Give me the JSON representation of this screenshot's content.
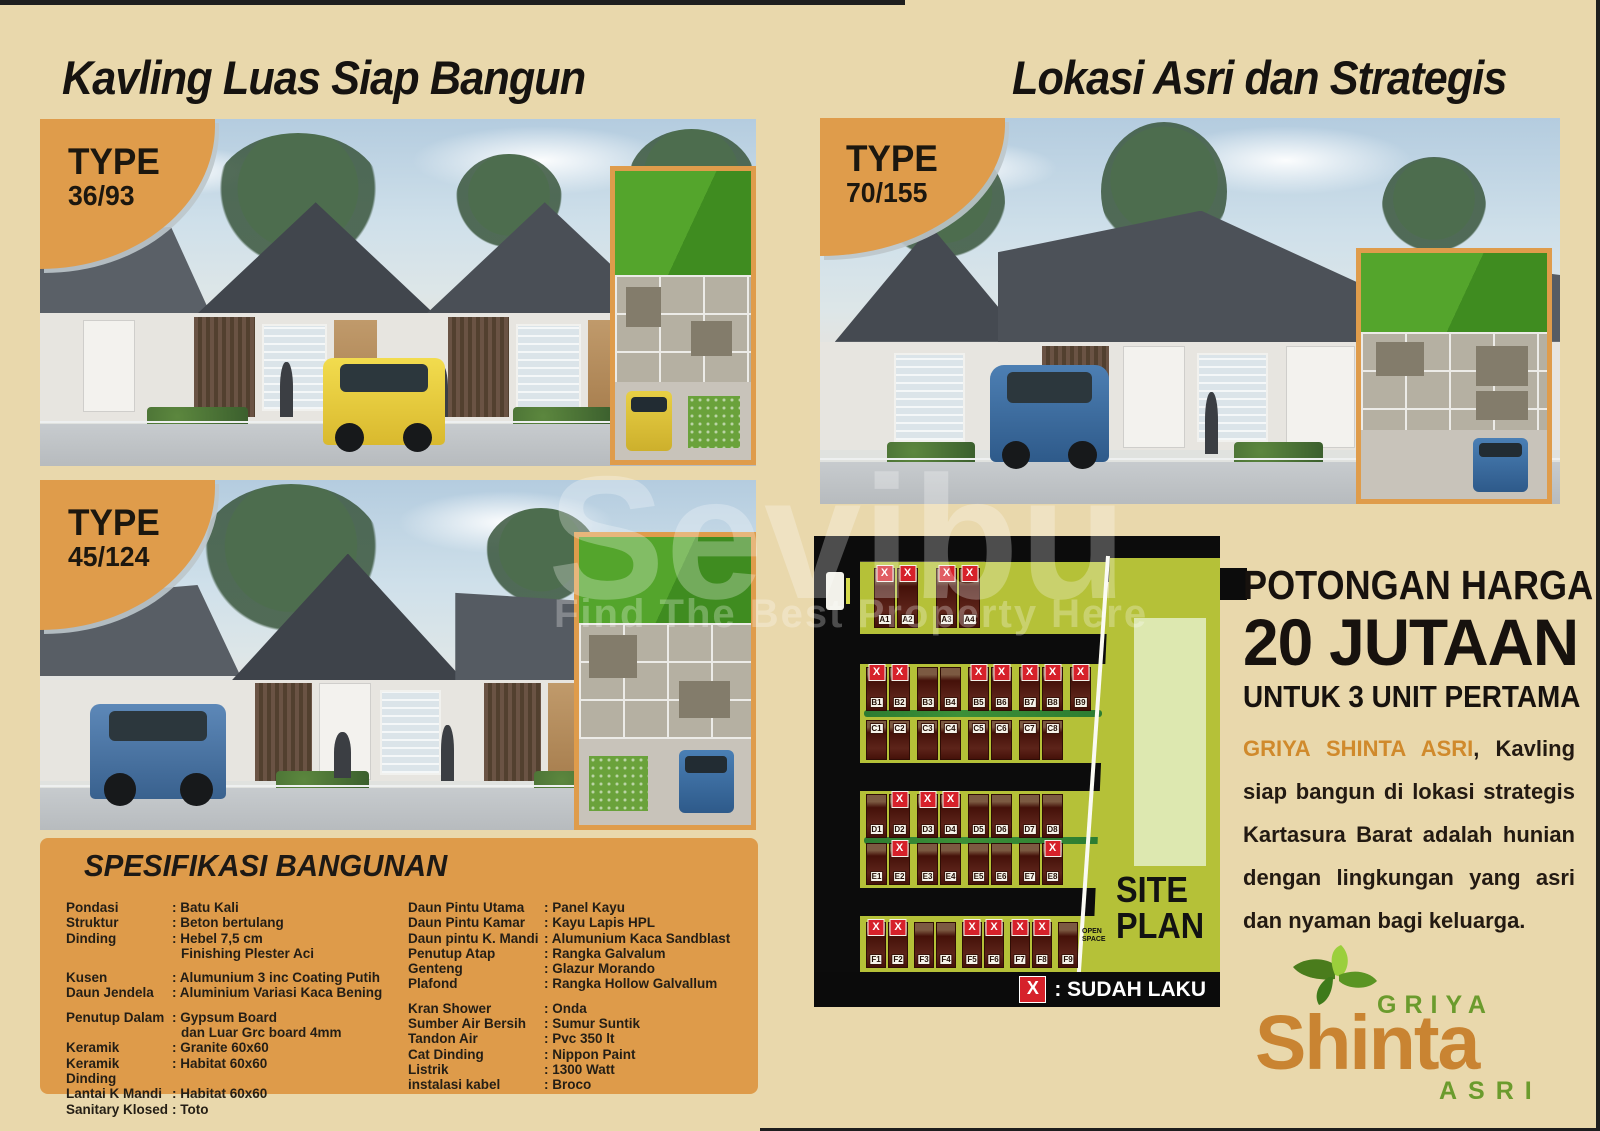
{
  "page": {
    "headline_left": "Kavling Luas Siap Bangun",
    "headline_right": "Lokasi Asri dan Strategis"
  },
  "watermark": {
    "brand": "Sevibu",
    "tagline": "Find The Best Property Here"
  },
  "listings": [
    {
      "id": "36-93",
      "type_label": "TYPE",
      "type_value": "36/93"
    },
    {
      "id": "45-124",
      "type_label": "TYPE",
      "type_value": "45/124"
    },
    {
      "id": "70-155",
      "type_label": "TYPE",
      "type_value": "70/155"
    }
  ],
  "specifications": {
    "title": "SPESIFIKASI BANGUNAN",
    "left": [
      {
        "label": "Pondasi",
        "value": ": Batu Kali"
      },
      {
        "label": "Struktur",
        "value": ": Beton bertulang"
      },
      {
        "label": "Dinding",
        "value": ": Hebel 7,5 cm",
        "value2": "Finishing Plester Aci",
        "gap_after": true
      },
      {
        "label": "Kusen",
        "value": ": Alumunium 3 inc Coating Putih"
      },
      {
        "label": "Daun Jendela",
        "value": ": Aluminium Variasi Kaca Bening",
        "gap_after": true
      },
      {
        "label": "Penutup Dalam",
        "value": ": Gypsum Board",
        "value2": "dan Luar Grc board 4mm"
      },
      {
        "label": "Keramik",
        "value": ": Granite 60x60"
      },
      {
        "label": "Keramik Dinding",
        "value": ": Habitat 60x60"
      },
      {
        "label": "Lantai K Mandi",
        "value": ": Habitat 60x60"
      },
      {
        "label": "Sanitary Klosed",
        "value": ": Toto"
      }
    ],
    "right": [
      {
        "label": "Daun Pintu Utama",
        "value": ": Panel Kayu"
      },
      {
        "label": "Daun Pintu Kamar",
        "value": ": Kayu Lapis HPL"
      },
      {
        "label": "Daun pintu K. Mandi",
        "value": ": Alumunium Kaca Sandblast"
      },
      {
        "label": "Penutup Atap",
        "value": ": Rangka Galvalum"
      },
      {
        "label": "Genteng",
        "value": ": Glazur Morando"
      },
      {
        "label": "Plafond",
        "value": ": Rangka Hollow Galvallum",
        "gap_after": true
      },
      {
        "label": "Kran Shower",
        "value": ": Onda"
      },
      {
        "label": "Sumber Air Bersih",
        "value": ": Sumur Suntik"
      },
      {
        "label": "Tandon Air",
        "value": ": Pvc 350 lt"
      },
      {
        "label": "Cat Dinding",
        "value": ": Nippon Paint"
      },
      {
        "label": "Listrik",
        "value": ": 1300 Watt"
      },
      {
        "label": "instalasi kabel",
        "value": ": Broco"
      }
    ]
  },
  "site_plan": {
    "label_line1": "SITE",
    "label_line2": "PLAN",
    "open_space": "OPEN SPACE",
    "legend": {
      "symbol": "X",
      "label": ": SUDAH LAKU"
    },
    "rows": [
      {
        "name": "A",
        "lots": [
          {
            "id": "A1",
            "sold": true
          },
          {
            "id": "A2",
            "sold": true,
            "wide_gap_after": true
          },
          {
            "id": "A3",
            "sold": true
          },
          {
            "id": "A4",
            "sold": true
          }
        ]
      },
      {
        "name": "B",
        "lots": [
          {
            "id": "B1",
            "sold": true
          },
          {
            "id": "B2",
            "sold": true,
            "gap_after": true
          },
          {
            "id": "B3",
            "sold": false
          },
          {
            "id": "B4",
            "sold": false,
            "gap_after": true
          },
          {
            "id": "B5",
            "sold": true
          },
          {
            "id": "B6",
            "sold": true,
            "gap_after": true
          },
          {
            "id": "B7",
            "sold": true
          },
          {
            "id": "B8",
            "sold": true,
            "gap_after": true
          },
          {
            "id": "B9",
            "sold": true
          }
        ]
      },
      {
        "name": "C",
        "lots": [
          {
            "id": "C1",
            "sold": false
          },
          {
            "id": "C2",
            "sold": false,
            "gap_after": true
          },
          {
            "id": "C3",
            "sold": false
          },
          {
            "id": "C4",
            "sold": false,
            "gap_after": true
          },
          {
            "id": "C5",
            "sold": false
          },
          {
            "id": "C6",
            "sold": false,
            "gap_after": true
          },
          {
            "id": "C7",
            "sold": false
          },
          {
            "id": "C8",
            "sold": false
          }
        ]
      },
      {
        "name": "D",
        "lots": [
          {
            "id": "D1",
            "sold": false
          },
          {
            "id": "D2",
            "sold": true,
            "gap_after": true
          },
          {
            "id": "D3",
            "sold": true
          },
          {
            "id": "D4",
            "sold": true,
            "gap_after": true
          },
          {
            "id": "D5",
            "sold": false
          },
          {
            "id": "D6",
            "sold": false,
            "gap_after": true
          },
          {
            "id": "D7",
            "sold": false
          },
          {
            "id": "D8",
            "sold": false
          }
        ]
      },
      {
        "name": "E",
        "lots": [
          {
            "id": "E1",
            "sold": false
          },
          {
            "id": "E2",
            "sold": true,
            "gap_after": true
          },
          {
            "id": "E3",
            "sold": false
          },
          {
            "id": "E4",
            "sold": false,
            "gap_after": true
          },
          {
            "id": "E5",
            "sold": false
          },
          {
            "id": "E6",
            "sold": false,
            "gap_after": true
          },
          {
            "id": "E7",
            "sold": false
          },
          {
            "id": "E8",
            "sold": true
          }
        ]
      },
      {
        "name": "F",
        "lots": [
          {
            "id": "F1",
            "sold": true
          },
          {
            "id": "F2",
            "sold": true,
            "gap_after": true
          },
          {
            "id": "F3",
            "sold": false
          },
          {
            "id": "F4",
            "sold": false,
            "gap_after": true
          },
          {
            "id": "F5",
            "sold": true
          },
          {
            "id": "F6",
            "sold": true,
            "gap_after": true
          },
          {
            "id": "F7",
            "sold": true
          },
          {
            "id": "F8",
            "sold": true,
            "gap_after": true
          },
          {
            "id": "F9",
            "sold": false
          }
        ]
      }
    ]
  },
  "promo": {
    "line1": "POTONGAN HARGA",
    "line2": "20 JUTAAN",
    "line3": "UNTUK 3 UNIT PERTAMA",
    "description_highlight": "GRIYA SHINTA ASRI",
    "description_rest": ", Kavling siap bangun di lokasi strategis Kartasura Barat adalah hunian dengan lingkungan yang asri dan nyaman bagi keluarga."
  },
  "logo": {
    "top": "GRIYA",
    "main": "Shinta",
    "bottom": "ASRI"
  },
  "colors": {
    "background": "#E9D8AC",
    "accent_orange": "#DF9C4B",
    "text_black": "#171310",
    "site_green": "#B5C138",
    "site_green_light": "#DDE8B0",
    "sold_red": "#D6212A",
    "house_maroon": "#571F16",
    "logo_orange": "#C98432",
    "logo_green": "#6B9B2D"
  }
}
